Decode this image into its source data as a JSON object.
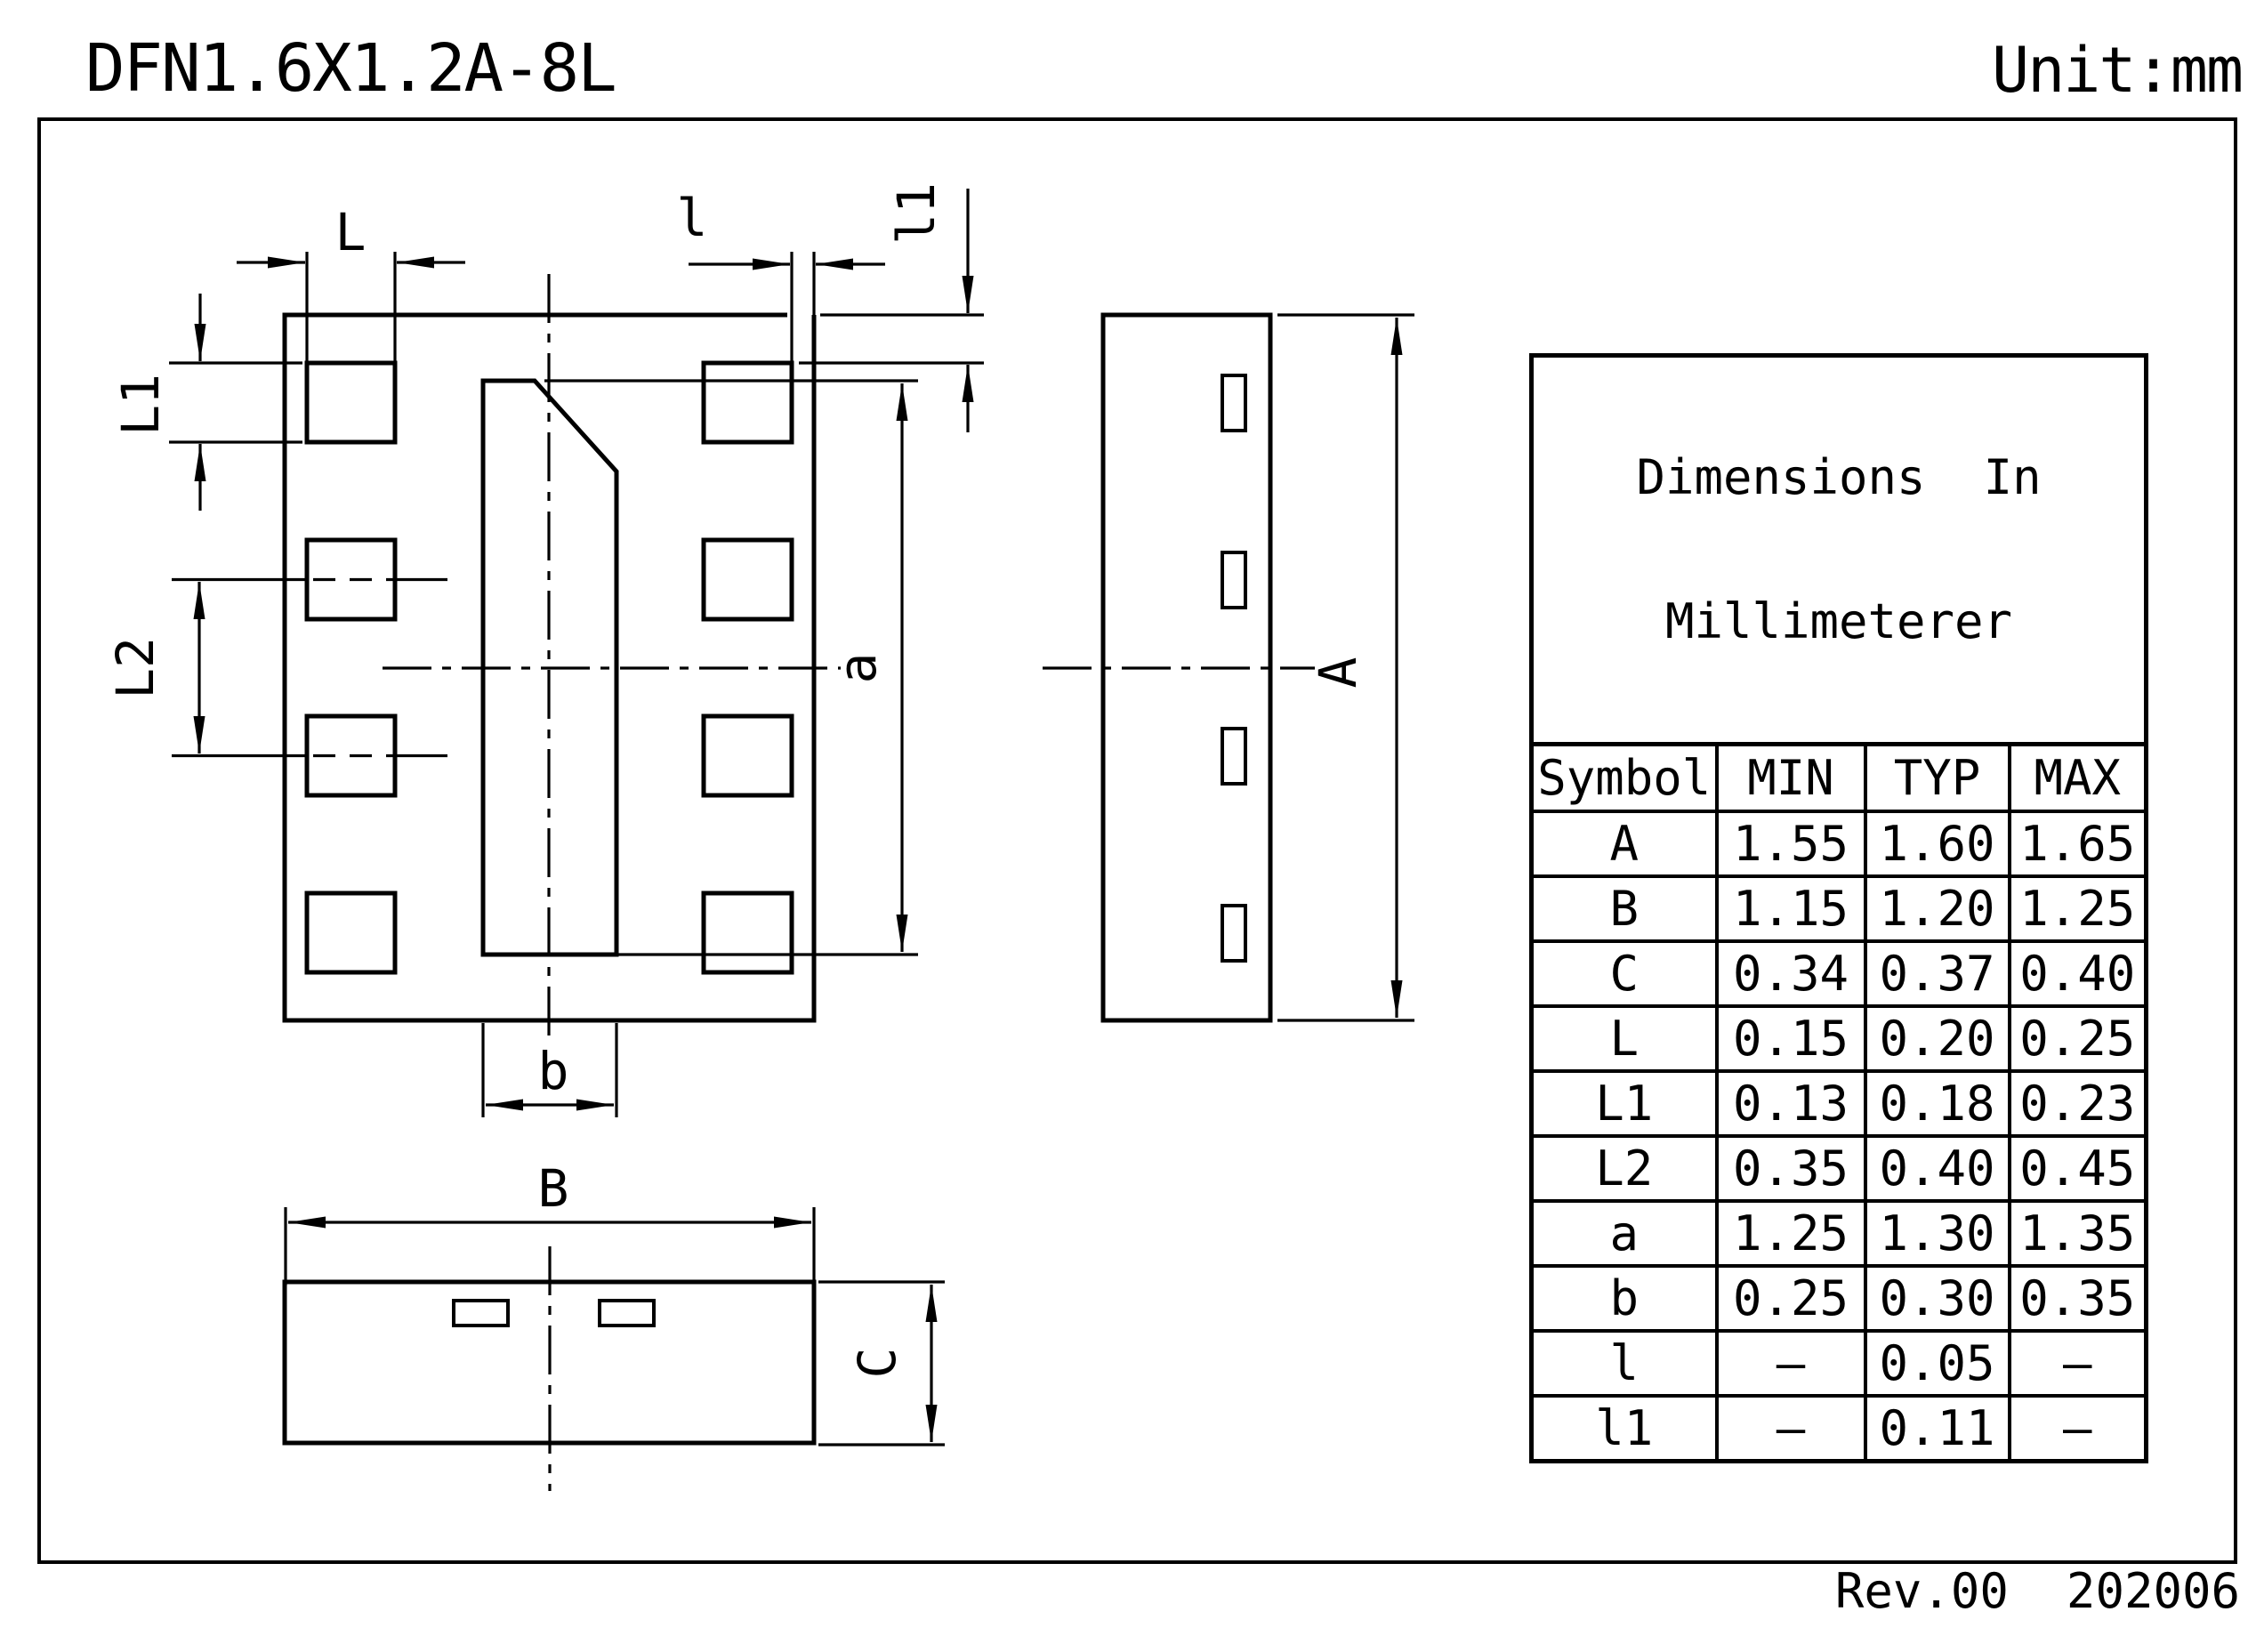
{
  "title": "DFN1.6X1.2A-8L",
  "unit_label": "Unit:mm",
  "revision": "Rev.00  202006",
  "drawing": {
    "labels": {
      "terminal_width": "L",
      "terminal_gap": "l",
      "terminal_top_offset": "l1",
      "terminal_height": "L1",
      "terminal_pitch": "L2",
      "epad_length": "a",
      "epad_width": "b",
      "body_width": "B",
      "body_length": "A",
      "body_thickness": "C"
    }
  },
  "table": {
    "title_line1": "Dimensions  In",
    "title_line2": "Millimeterer",
    "headers": [
      "Symbol",
      "MIN",
      "TYP",
      "MAX"
    ],
    "rows": [
      {
        "symbol": "A",
        "min": "1.55",
        "typ": "1.60",
        "max": "1.65"
      },
      {
        "symbol": "B",
        "min": "1.15",
        "typ": "1.20",
        "max": "1.25"
      },
      {
        "symbol": "C",
        "min": "0.34",
        "typ": "0.37",
        "max": "0.40"
      },
      {
        "symbol": "L",
        "min": "0.15",
        "typ": "0.20",
        "max": "0.25"
      },
      {
        "symbol": "L1",
        "min": "0.13",
        "typ": "0.18",
        "max": "0.23"
      },
      {
        "symbol": "L2",
        "min": "0.35",
        "typ": "0.40",
        "max": "0.45"
      },
      {
        "symbol": "a",
        "min": "1.25",
        "typ": "1.30",
        "max": "1.35"
      },
      {
        "symbol": "b",
        "min": "0.25",
        "typ": "0.30",
        "max": "0.35"
      },
      {
        "symbol": "l",
        "min": "–",
        "typ": "0.05",
        "max": "–"
      },
      {
        "symbol": "l1",
        "min": "–",
        "typ": "0.11",
        "max": "–"
      }
    ]
  }
}
